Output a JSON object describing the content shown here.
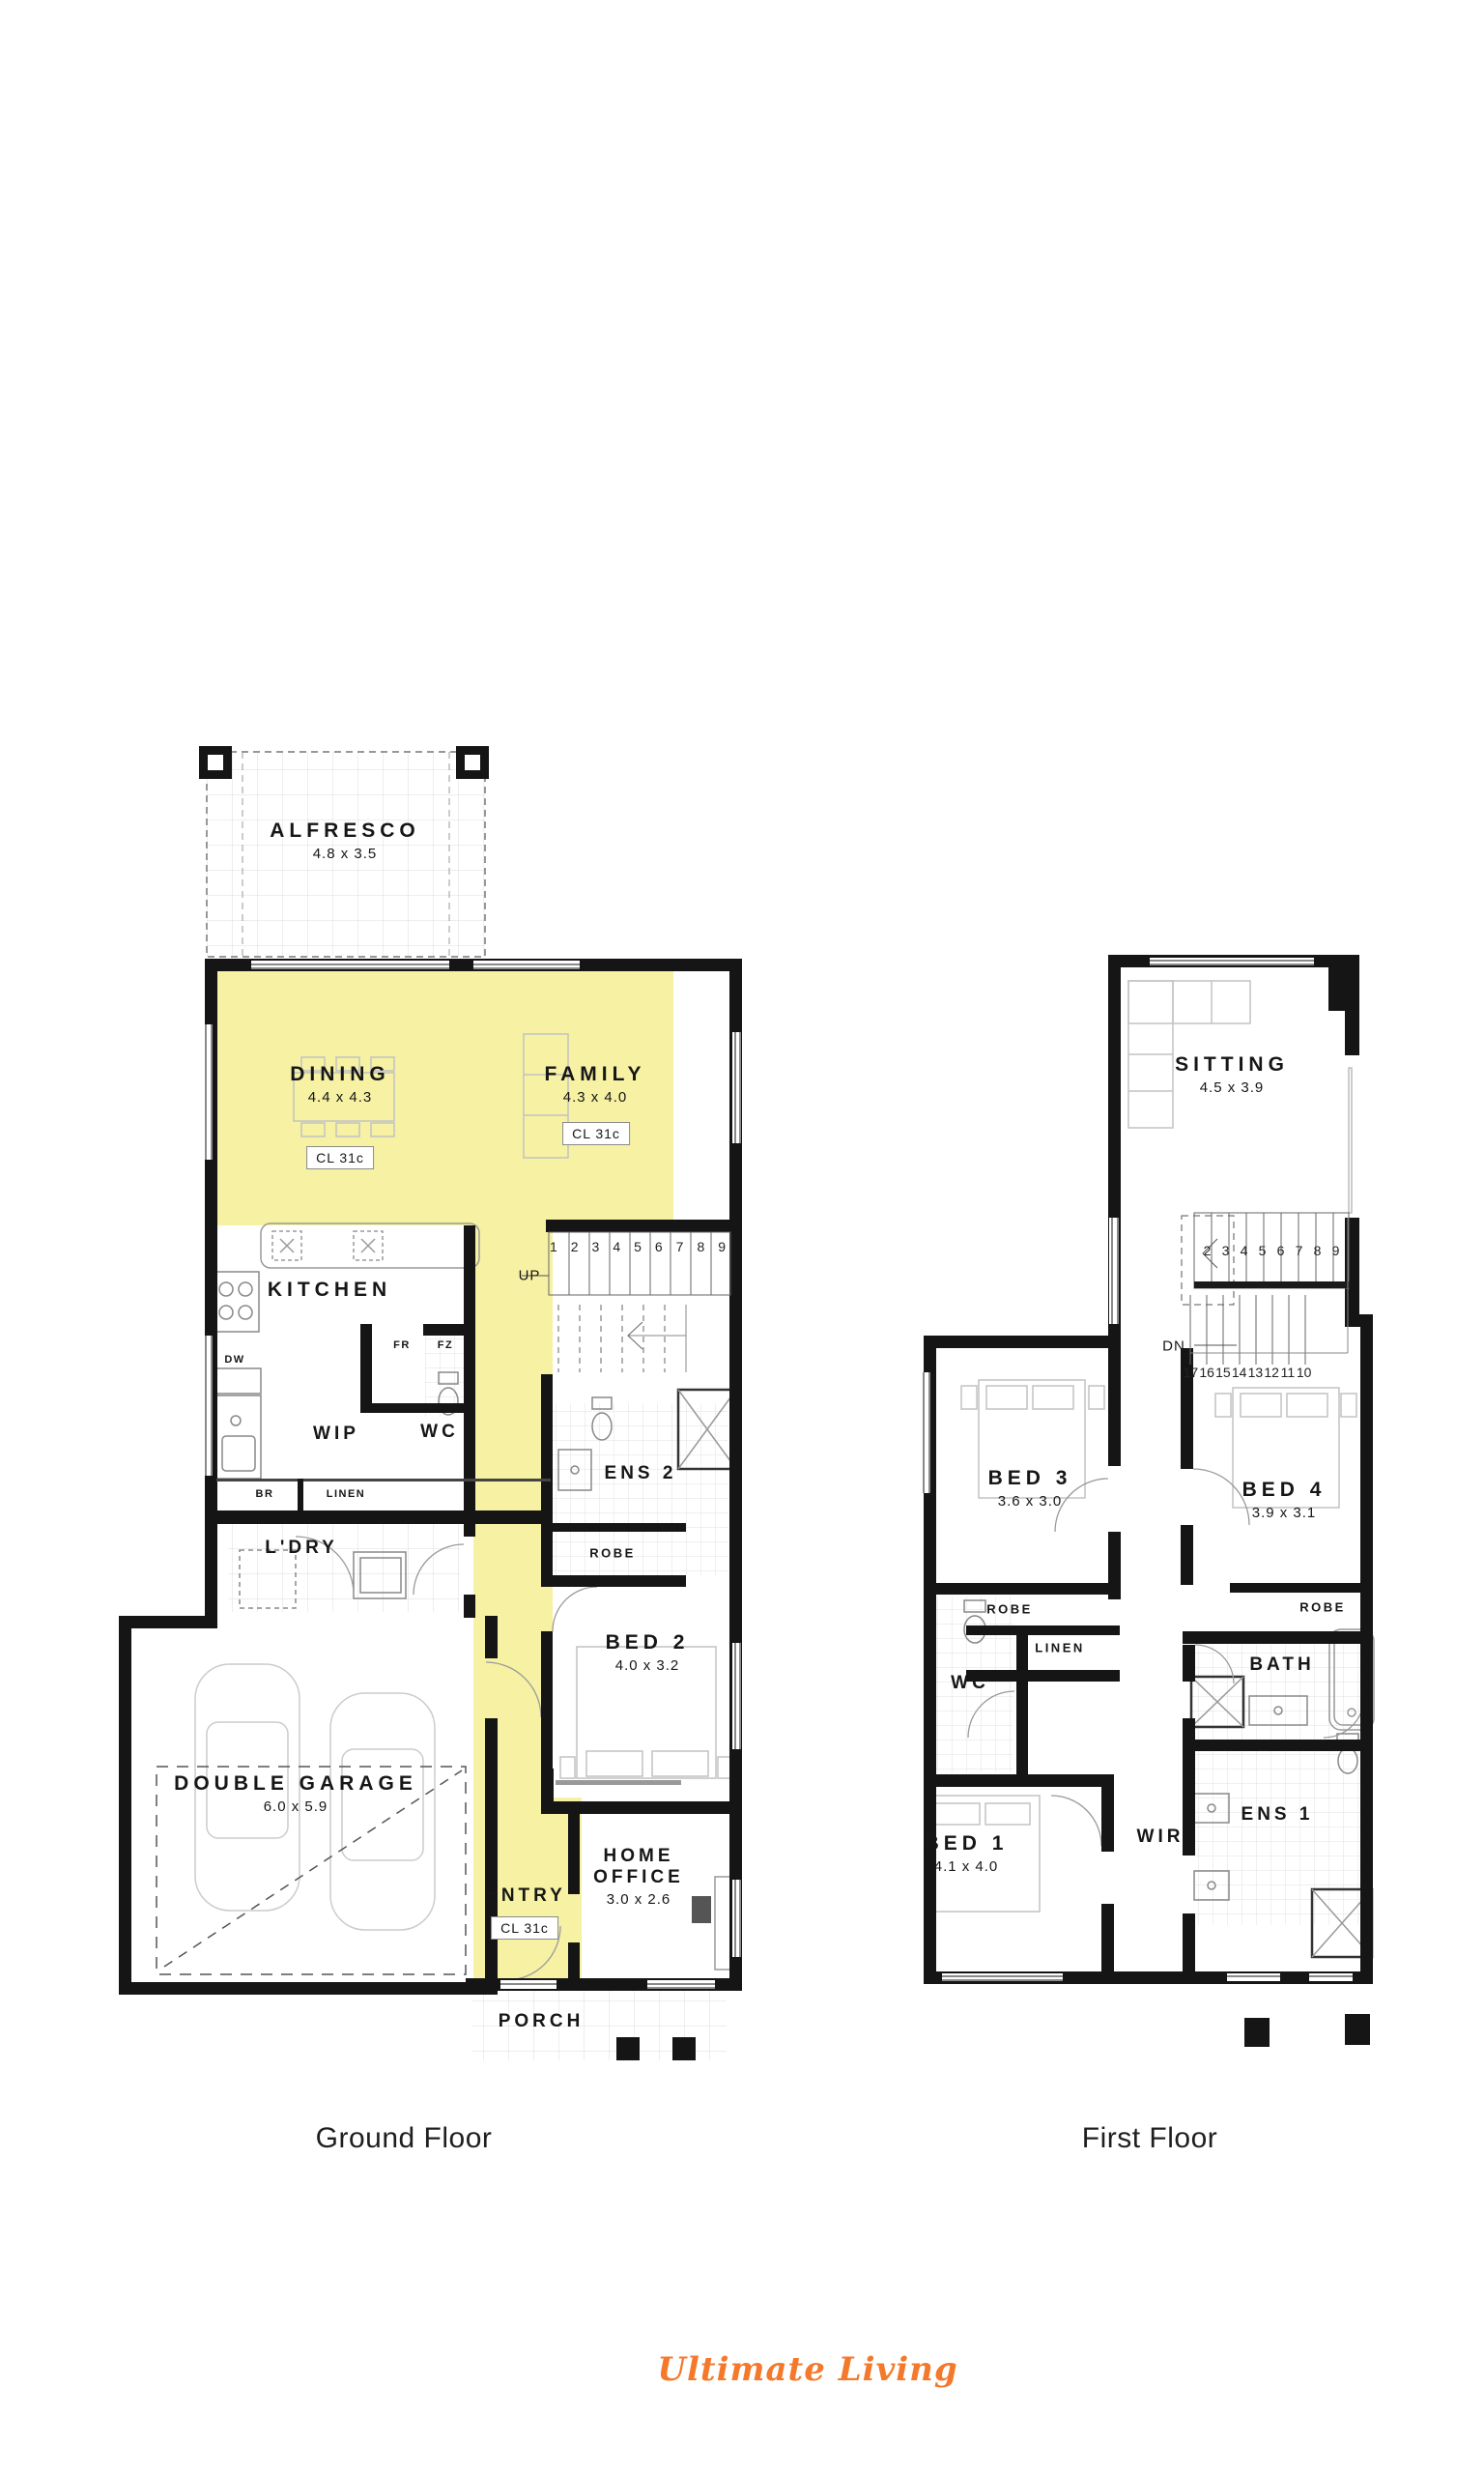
{
  "document": {
    "type": "house-floor-plan"
  },
  "branding": {
    "logo_text": "Ultimate Living",
    "logo_color": "#f4792b"
  },
  "colors": {
    "highlight_yellow": "#f6f1a3",
    "wall_black": "#151515",
    "furniture_gray": "#c2c2c2",
    "tile_gray": "#dcdcdc"
  },
  "ground_floor": {
    "caption": "Ground Floor",
    "alfresco": {
      "name": "ALFRESCO",
      "dims": "4.8 x 3.5"
    },
    "dining": {
      "name": "DINING",
      "dims": "4.4 x 4.3",
      "ceiling": "CL 31c"
    },
    "family": {
      "name": "FAMILY",
      "dims": "4.3 x 4.0",
      "ceiling": "CL 31c"
    },
    "kitchen": {
      "name": "KITCHEN"
    },
    "wip": {
      "name": "WIP"
    },
    "wc": {
      "name": "WC"
    },
    "ens2": {
      "name": "ENS 2"
    },
    "ldry": {
      "name": "L'DRY"
    },
    "bed2": {
      "name": "BED 2",
      "dims": "4.0 x 3.2"
    },
    "garage": {
      "name": "DOUBLE GARAGE",
      "dims": "6.0 x 5.9"
    },
    "entry": {
      "name": "ENTRY",
      "ceiling": "CL 31c"
    },
    "home_office": {
      "name": "HOME OFFICE",
      "dims": "3.0 x 2.6"
    },
    "porch": {
      "name": "PORCH"
    },
    "robe": "ROBE",
    "linen": "LINEN",
    "br": "BR",
    "dw": "DW",
    "fr": "FR",
    "fz": "FZ",
    "up": "UP",
    "stair_numbers": [
      "1",
      "2",
      "3",
      "4",
      "5",
      "6",
      "7",
      "8",
      "9"
    ]
  },
  "first_floor": {
    "caption": "First Floor",
    "sitting": {
      "name": "SITTING",
      "dims": "4.5 x 3.9"
    },
    "bed3": {
      "name": "BED 3",
      "dims": "3.6 x 3.0"
    },
    "bed4": {
      "name": "BED 4",
      "dims": "3.9 x 3.1"
    },
    "wc": {
      "name": "WC"
    },
    "bath": {
      "name": "BATH"
    },
    "bed1": {
      "name": "BED 1",
      "dims": "4.1 x 4.0"
    },
    "wir": {
      "name": "WIR"
    },
    "ens1": {
      "name": "ENS 1"
    },
    "robe_left": "ROBE",
    "robe_right": "ROBE",
    "linen": "LINEN",
    "dn": "DN",
    "stair_numbers_upper": [
      "2",
      "3",
      "4",
      "5",
      "6",
      "7",
      "8",
      "9"
    ],
    "stair_numbers_lower": [
      "17",
      "16",
      "15",
      "14",
      "13",
      "12",
      "11",
      "10"
    ]
  }
}
